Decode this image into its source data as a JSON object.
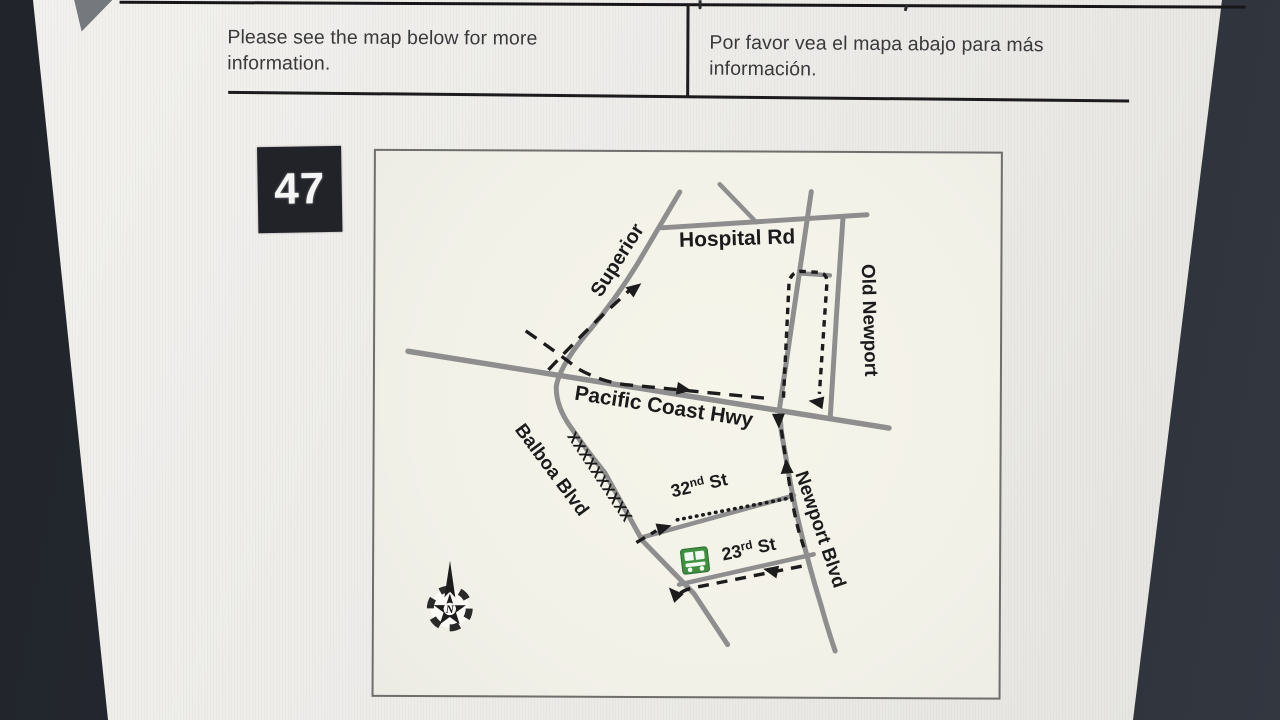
{
  "notice": {
    "english": "Please see the map below for more information.",
    "spanish": "Por favor vea el mapa abajo para más información."
  },
  "route_badge": {
    "number": "47"
  },
  "map": {
    "labels": {
      "superior": "Superior",
      "hospital_rd": "Hospital Rd",
      "old_newport": "Old Newport",
      "pacific_coast_hwy": "Pacific Coast Hwy",
      "balboa_blvd": "Balboa Blvd",
      "newport_blvd": "Newport Blvd",
      "street_32_num": "32",
      "street_32_sup": "nd",
      "street_32_suffix": " St",
      "street_23_num": "23",
      "street_23_sup": "rd",
      "street_23_suffix": " St",
      "closure_marks": "XXXXXXXXXX",
      "compass_north": "N"
    },
    "colors": {
      "road": "#8e8e8e",
      "detour_dash": "#1c1c1c",
      "bus_icon_green": "#3f9140",
      "map_background": "#f4f3ea"
    }
  },
  "colors": {
    "page": "#edece9",
    "photo_background": "#282c34",
    "badge_background": "#212329",
    "badge_text": "#f5f5f5",
    "rule": "#1c1c1e"
  }
}
